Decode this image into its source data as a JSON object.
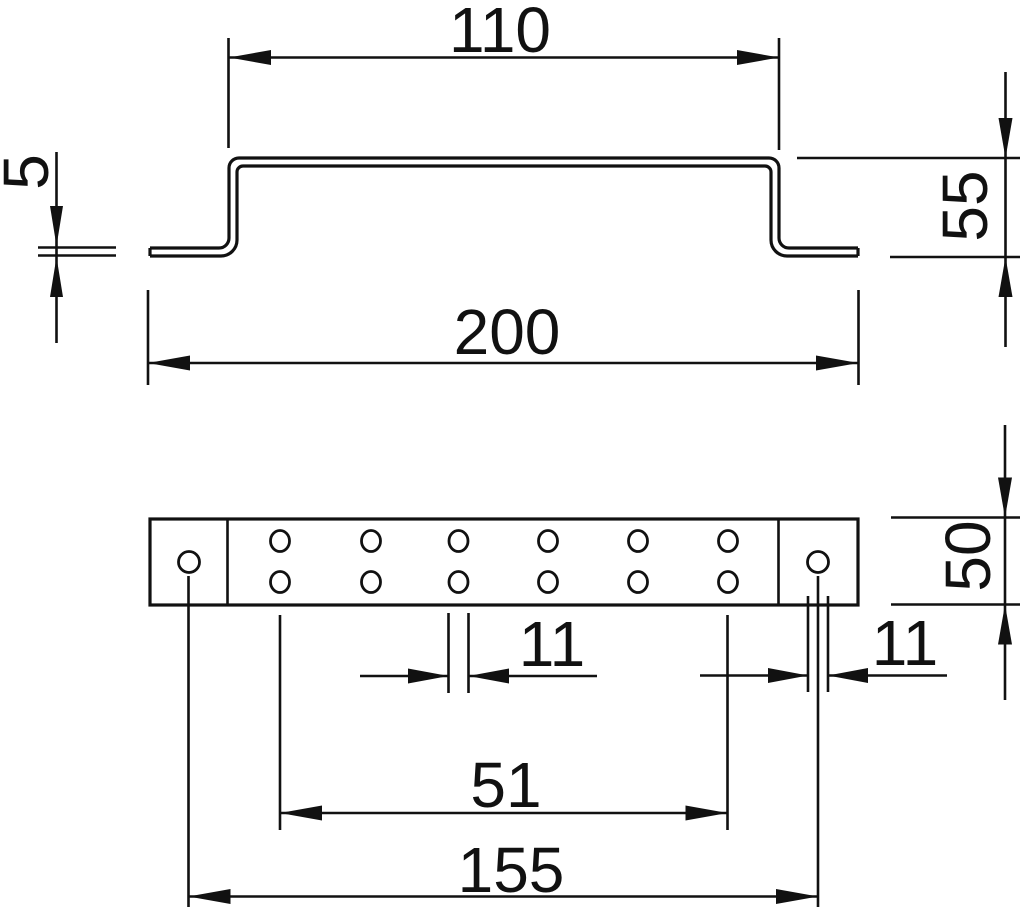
{
  "drawing": {
    "type": "technical-dimension-drawing",
    "background": "#ffffff",
    "line_color": "#111111",
    "views": {
      "top_view": {
        "description": "hat-profile cross-section",
        "dimensions": {
          "top_width": "110",
          "material_thickness": "5",
          "height": "55",
          "overall_width": "200"
        }
      },
      "bottom_view": {
        "description": "plan view with holes",
        "hole_columns": 6,
        "hole_rows": 2,
        "end_holes": 2,
        "dimensions": {
          "depth": "50",
          "hole_width": "11",
          "end_hole_width": "11",
          "hole_span": "51",
          "end_hole_span": "155"
        }
      }
    }
  },
  "labels": {
    "top_width": "110",
    "thickness": "5",
    "height": "55",
    "overall_width": "200",
    "depth": "50",
    "hole_width": "11",
    "end_hole_width": "11",
    "hole_span": "51",
    "end_hole_span": "155"
  }
}
